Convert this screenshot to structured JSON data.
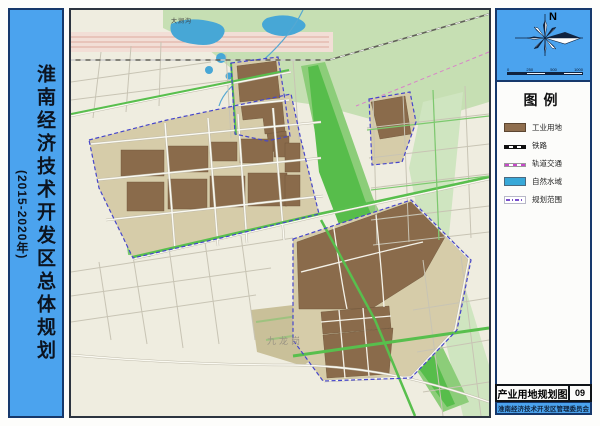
{
  "left_panel": {
    "title_main": "淮南经济技术开发区总体规划",
    "title_year": "(2015-2020年)"
  },
  "compass": {
    "north_label": "N"
  },
  "scalebar": {
    "ticks": [
      "0",
      "250",
      "500",
      "1000"
    ]
  },
  "legend": {
    "title": "图例",
    "items": [
      {
        "label": "工业用地",
        "type": "industrial-swatch",
        "color": "#8f6e4e"
      },
      {
        "label": "铁路",
        "type": "railway-line",
        "color": "#101010"
      },
      {
        "label": "轨道交通",
        "type": "transit-line",
        "color": "#c649c8"
      },
      {
        "label": "自然水域",
        "type": "water-swatch",
        "color": "#38a8d8"
      },
      {
        "label": "规划范围",
        "type": "boundary-line",
        "color": "#7a50cc"
      }
    ]
  },
  "titleblock": {
    "map_name": "产业用地规划图",
    "sheet_number": "09",
    "agency": "淮南经济技术开发区管理委员会"
  },
  "map": {
    "labels": {
      "river": "大涧沟",
      "district": "九龙岗"
    },
    "colors": {
      "panel_blue": "#4ba3ee",
      "border_navy": "#16386b",
      "map_background": "#efede0",
      "planning_block": "#d6cca9",
      "industrial_brown": "#8a6b4b",
      "green_light": "#c6dfb3",
      "green_bright": "#57bd4b",
      "water_blue": "#47a7d6",
      "pond_cyan": "#3fbfe5",
      "boundary_dash_blue": "#4646cb",
      "rail_corridor_pink": "#f2ded6"
    }
  }
}
